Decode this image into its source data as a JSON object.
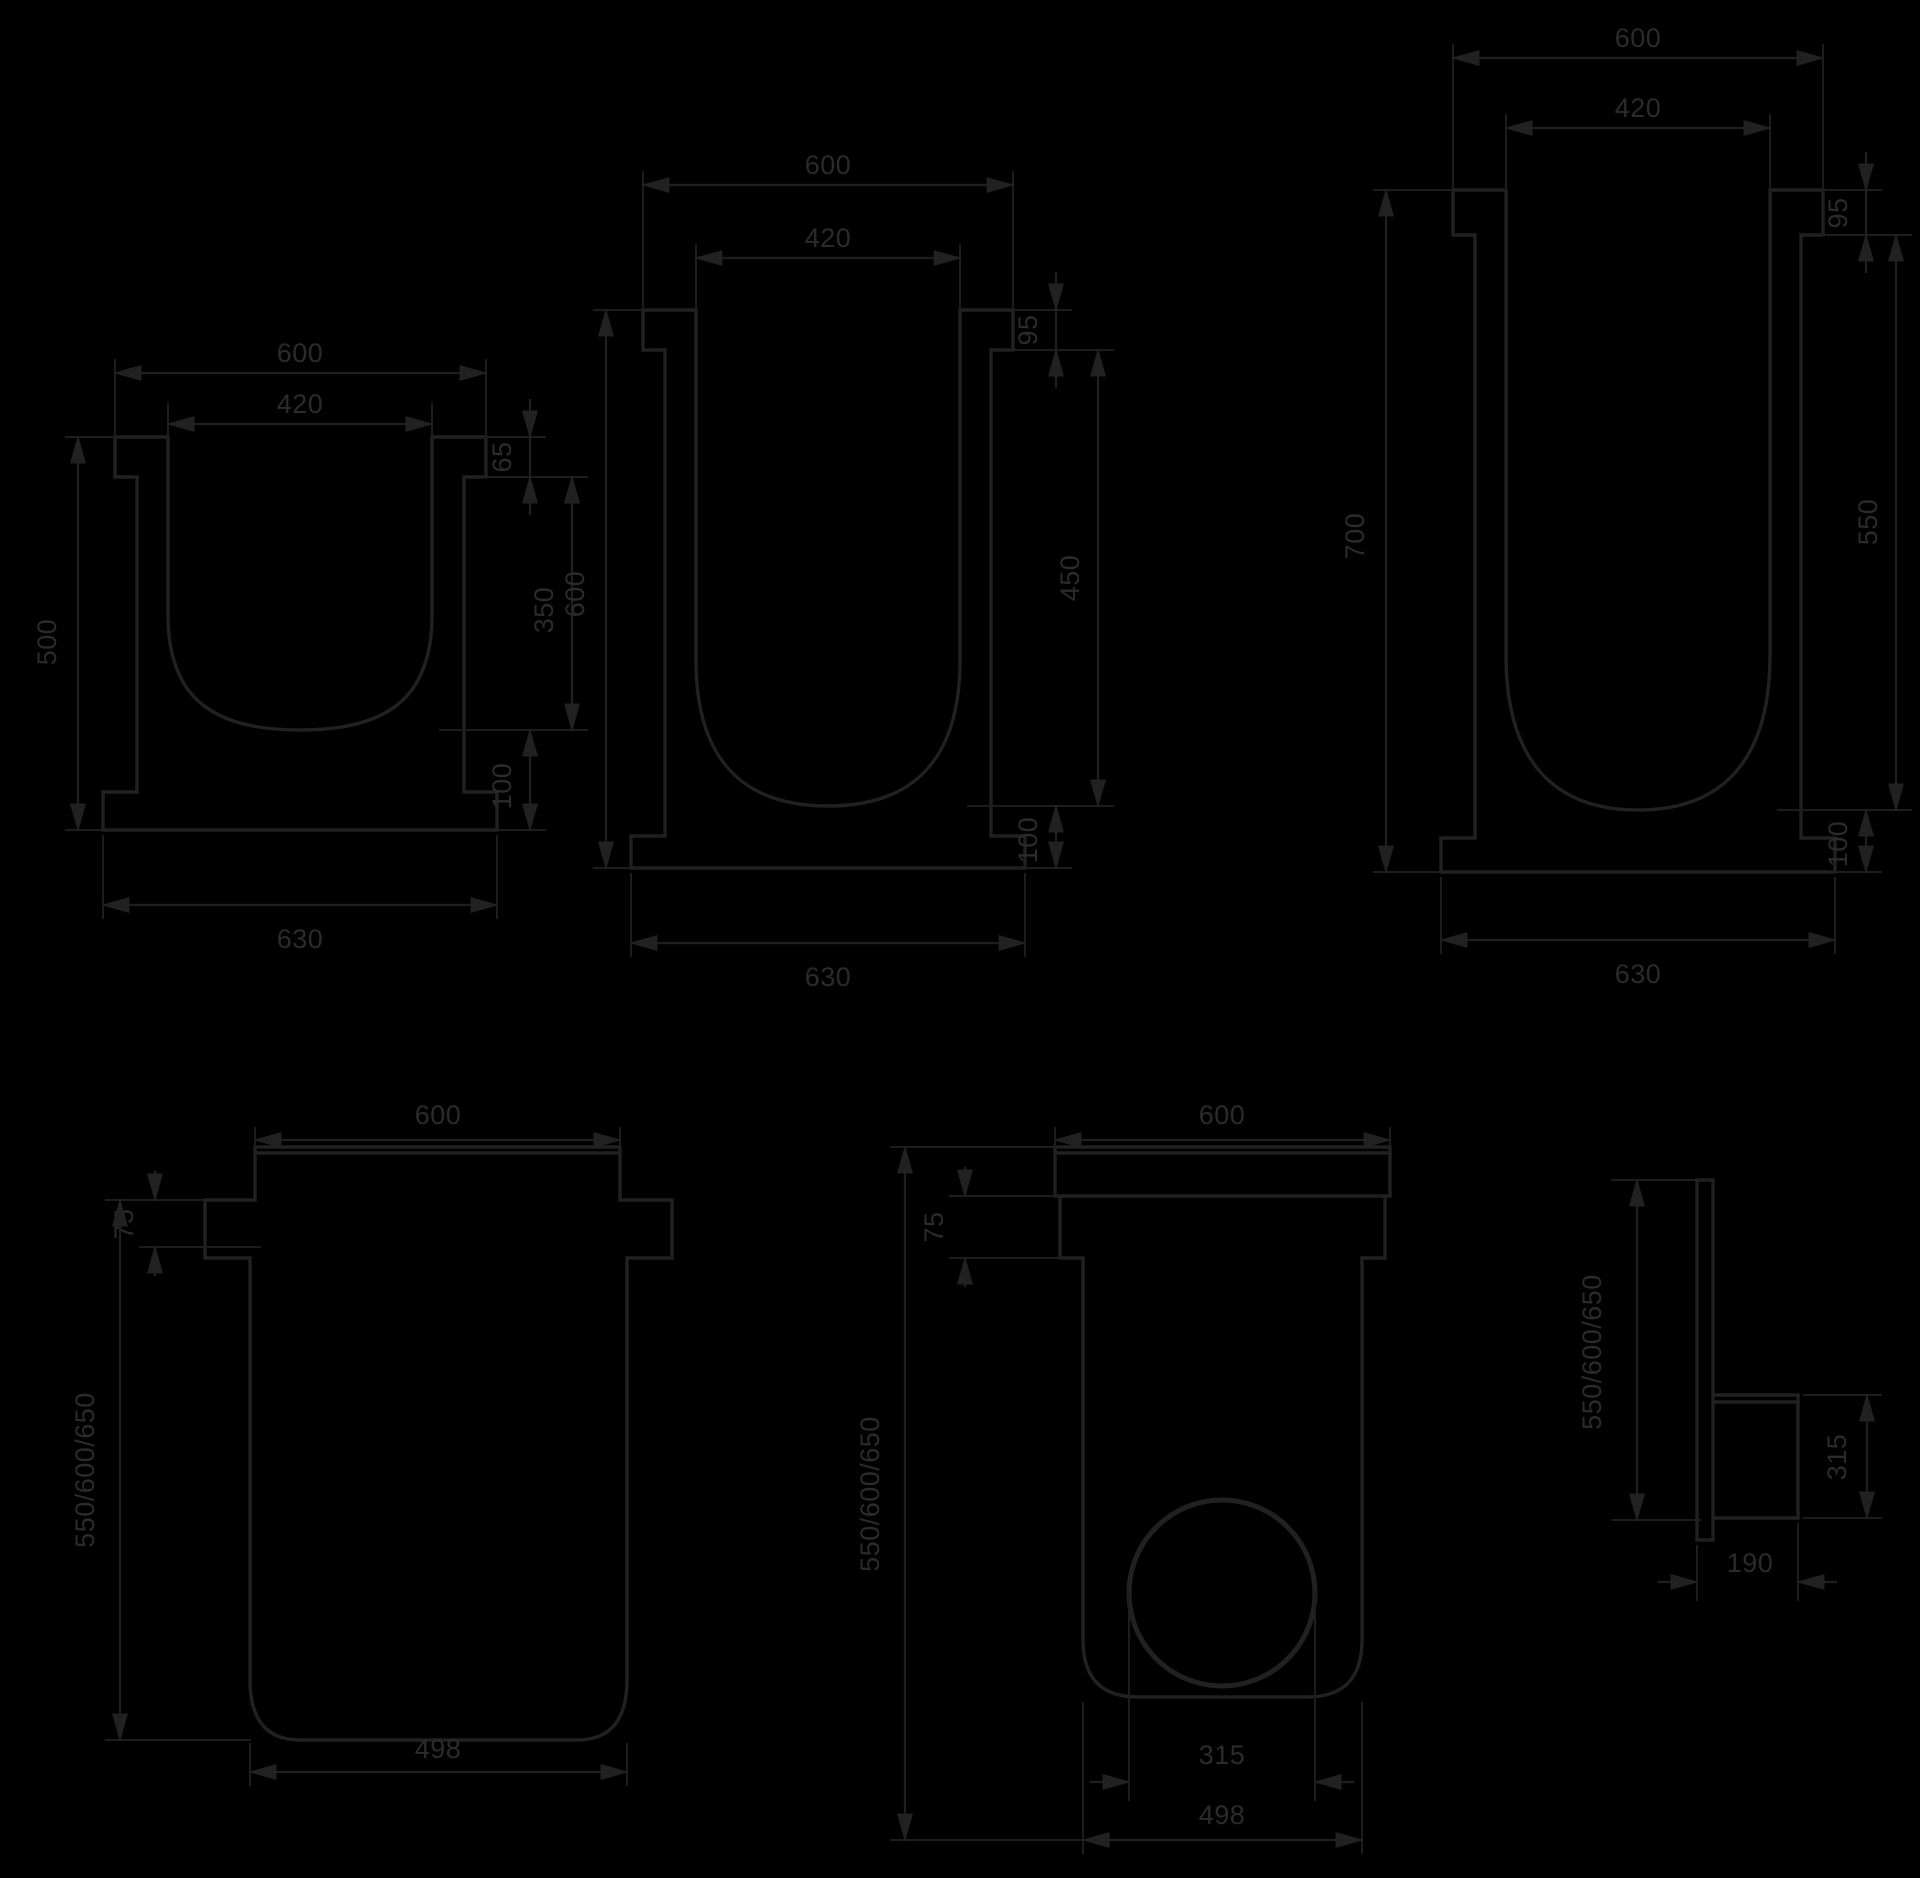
{
  "drawing": {
    "background_color": "#000000",
    "line_color": "#212121",
    "text_color": "#2b2b2b",
    "diagrams": {
      "channel_1": {
        "dims": {
          "top_width": "600",
          "inner_width": "420",
          "height": "500",
          "rail_height": "65",
          "inner_depth": "350",
          "base_thickness": "100",
          "bottom_width": "630"
        }
      },
      "channel_2": {
        "dims": {
          "top_width": "600",
          "inner_width": "420",
          "height": "600",
          "rail_height": "95",
          "inner_depth": "450",
          "base_thickness": "100",
          "bottom_width": "630"
        }
      },
      "channel_3": {
        "dims": {
          "top_width": "600",
          "inner_width": "420",
          "height": "700",
          "rail_height": "95",
          "inner_depth": "550",
          "base_thickness": "100",
          "bottom_width": "630"
        }
      },
      "outfall_closed": {
        "dims": {
          "top_width": "600",
          "rim_height": "75",
          "heights": "550/600/650",
          "bottom_width": "498"
        }
      },
      "outfall_outlet": {
        "dims": {
          "top_width": "600",
          "rim_height": "75",
          "heights": "550/600/650",
          "pipe_diameter": "315",
          "bottom_width": "498"
        }
      },
      "end_wall_side": {
        "dims": {
          "heights": "550/600/650",
          "outlet_height": "315",
          "outlet_depth": "190"
        }
      }
    }
  }
}
